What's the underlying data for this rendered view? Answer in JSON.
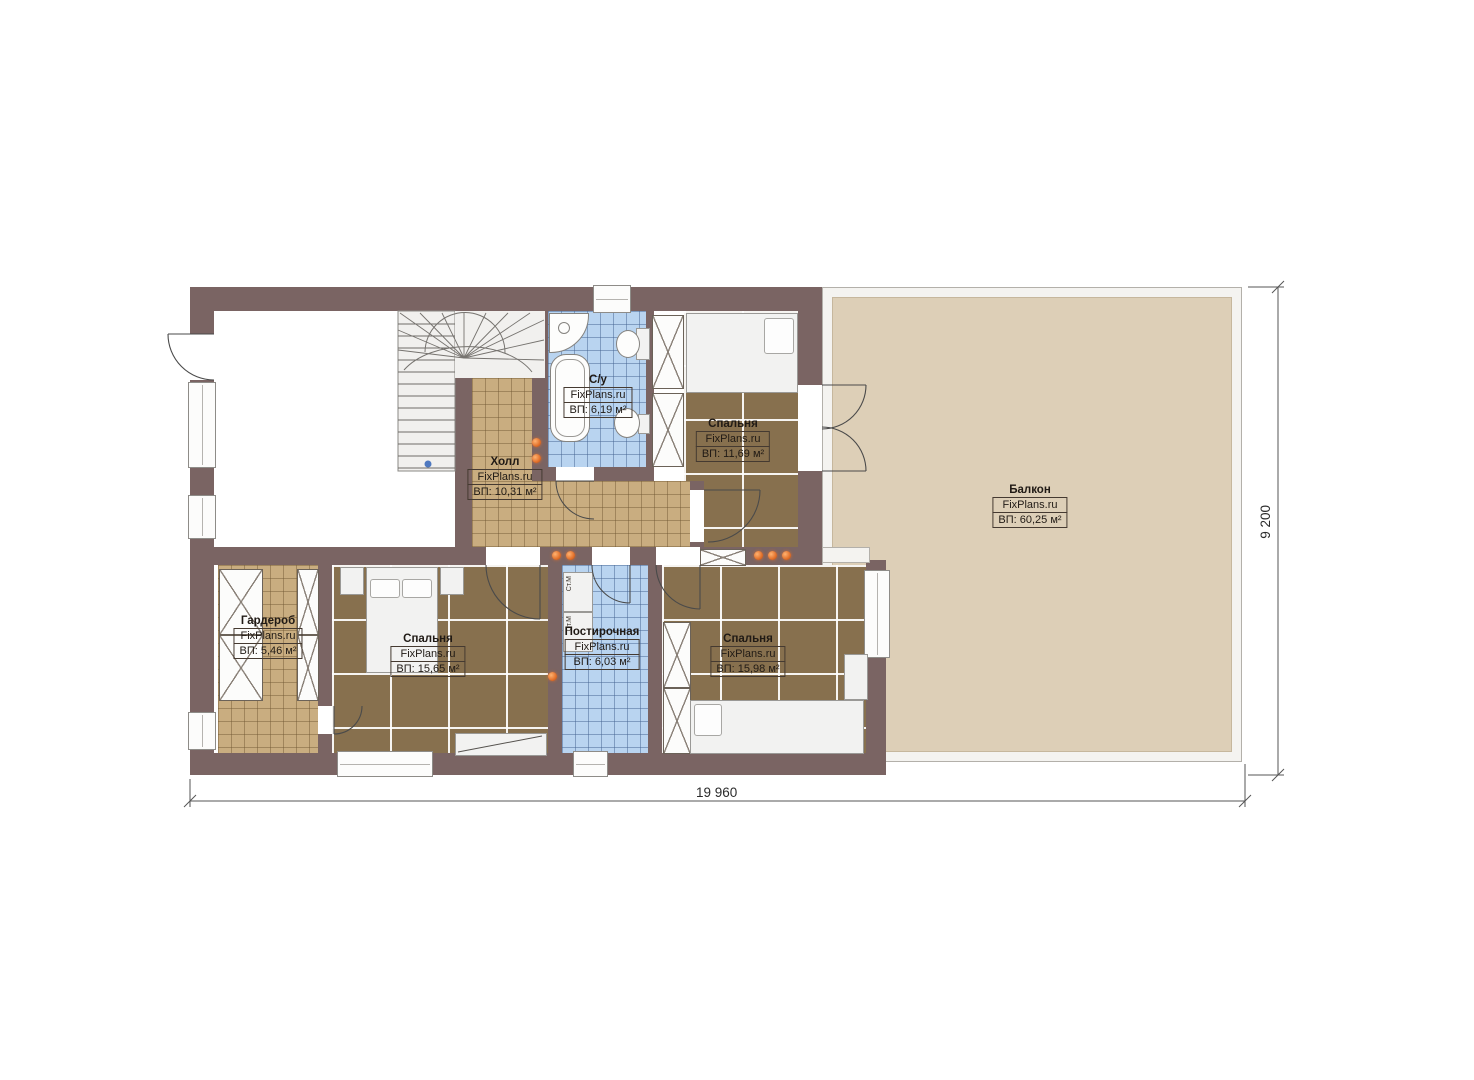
{
  "plan": {
    "brand": "FixPlans.ru",
    "rooms": [
      {
        "key": "hall",
        "name": "Холл",
        "brand": "FixPlans.ru",
        "area": "ВП: 10,31 м²"
      },
      {
        "key": "bathroom",
        "name": "С/у",
        "brand": "FixPlans.ru",
        "area": "ВП: 6,19 м²"
      },
      {
        "key": "bedroom-top",
        "name": "Спальня",
        "brand": "FixPlans.ru",
        "area": "ВП: 11,69 м²"
      },
      {
        "key": "balcony",
        "name": "Балкон",
        "brand": "FixPlans.ru",
        "area": "ВП: 60,25 м²"
      },
      {
        "key": "wardrobe",
        "name": "Гардероб",
        "brand": "FixPlans.ru",
        "area": "ВП: 5,46 м²"
      },
      {
        "key": "bedroom-left",
        "name": "Спальня",
        "brand": "FixPlans.ru",
        "area": "ВП: 15,65 м²"
      },
      {
        "key": "laundry",
        "name": "Постирочная",
        "brand": "FixPlans.ru",
        "area": "ВП: 6,03 м²"
      },
      {
        "key": "bedroom-right",
        "name": "Спальня",
        "brand": "FixPlans.ru",
        "area": "ВП: 15,98 м²"
      }
    ],
    "dimensions": {
      "overall_width": "19 960",
      "overall_height": "9 200"
    },
    "labels": {
      "washing_machine": "Ст.М",
      "dryer": "Ст.М"
    },
    "colors": {
      "wall": "#7a6463",
      "wood_floor": "#87704e",
      "tile_beige": "#c9ad80",
      "tile_blue": "#b9d4f0",
      "balcony_floor": "#ddcfb7",
      "light_accent": "#e2702a"
    }
  }
}
